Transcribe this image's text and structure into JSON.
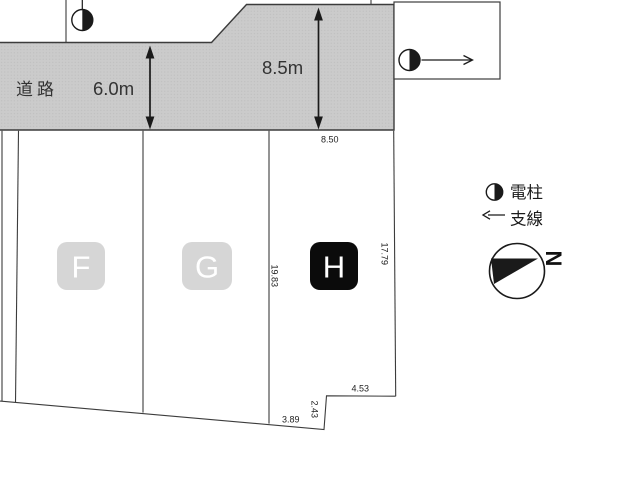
{
  "road": {
    "name_label": "道路",
    "width_front_label": "6.0m",
    "width_side_label": "8.5m"
  },
  "lots": [
    {
      "label": "F"
    },
    {
      "label": "G"
    },
    {
      "label": "H"
    }
  ],
  "dims": {
    "h_frontage": "8.50",
    "gh_boundary": "19.83",
    "h_east_side": "17.79",
    "h_south_west": "3.89",
    "h_step": "2.43",
    "h_south_east": "4.53"
  },
  "legend": {
    "pole_label": "電柱",
    "wire_label": "支線",
    "north_label": "N"
  },
  "colors": {
    "road_fill": "#cbcbcb",
    "road_dot": "#bcbcbc",
    "line": "#3c3c3c",
    "ink": "#1a1a1a",
    "badge_gray": "#d6d6d6",
    "badge_dark": "#0b0b0b",
    "badge_text": "#ffffff"
  }
}
